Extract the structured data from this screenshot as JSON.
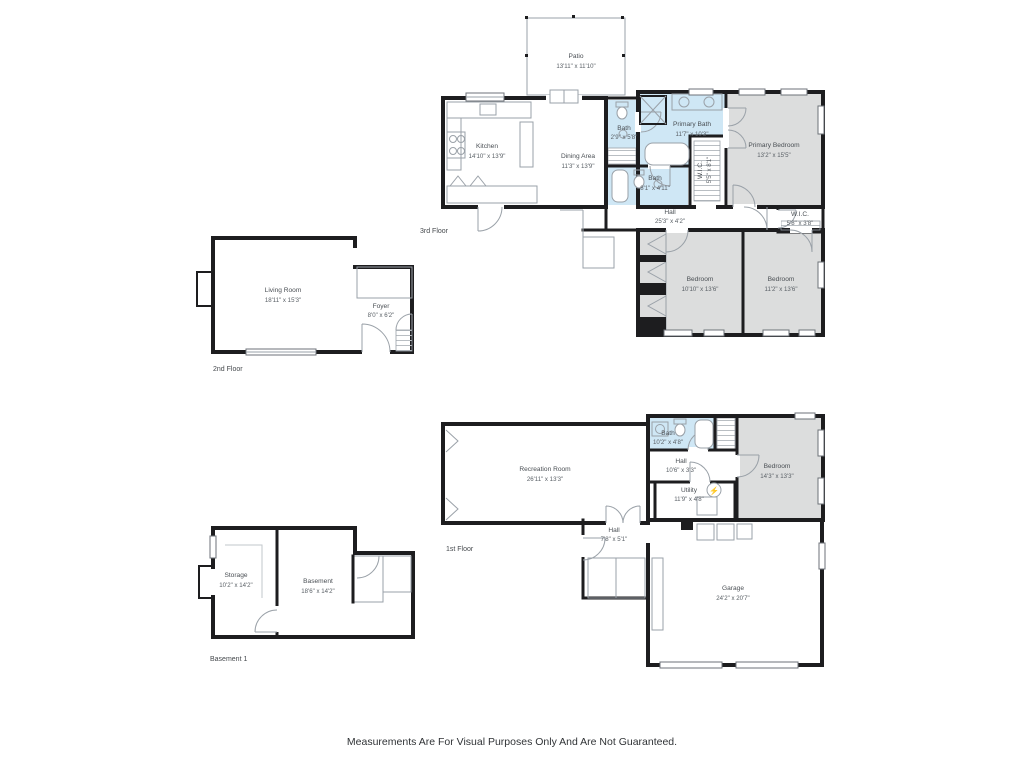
{
  "disclaimer": "Measurements Are For Visual Purposes Only And Are Not Guaranteed.",
  "icons": {
    "electrical_panel": "⚡"
  },
  "colors": {
    "wall": "#1d1d1f",
    "bath_fill": "#cfe7f5",
    "bedroom_fill": "#dcdddd",
    "fixture_line": "#9aa1a8",
    "text": "#4a4f54"
  },
  "floors": {
    "third": {
      "label": "3rd Floor",
      "rooms": {
        "patio": {
          "name": "Patio",
          "dims": "13'11\" x 11'10\""
        },
        "kitchen": {
          "name": "Kitchen",
          "dims": "14'10\" x 13'9\""
        },
        "dining": {
          "name": "Dining Area",
          "dims": "11'3\" x 13'9\""
        },
        "bath_wc": {
          "name": "Bath",
          "dims": "2'9\" x 5'8\""
        },
        "primary_bath": {
          "name": "Primary Bath",
          "dims": "11'7\" x 10'3\""
        },
        "primary_bedroom": {
          "name": "Primary Bedroom",
          "dims": "13'2\" x 15'5\""
        },
        "wic_a": {
          "name": "W.I.C.",
          "dims": "5'5\" x 8'1\""
        },
        "bath_b": {
          "name": "Bath",
          "dims": "8'1\" x 4'11\""
        },
        "hall": {
          "name": "Hall",
          "dims": "25'3\" x 4'2\""
        },
        "wic_b": {
          "name": "W.I.C.",
          "dims": "5'8\" x 3'8\""
        },
        "bedroom_a": {
          "name": "Bedroom",
          "dims": "10'10\" x 13'6\""
        },
        "bedroom_b": {
          "name": "Bedroom",
          "dims": "11'2\" x 13'6\""
        }
      }
    },
    "second": {
      "label": "2nd Floor",
      "rooms": {
        "living": {
          "name": "Living Room",
          "dims": "18'11\" x 15'3\""
        },
        "foyer": {
          "name": "Foyer",
          "dims": "8'0\" x 6'2\""
        }
      }
    },
    "first": {
      "label": "1st Floor",
      "rooms": {
        "recreation": {
          "name": "Recreation Room",
          "dims": "26'11\" x 13'3\""
        },
        "bath": {
          "name": "Bath",
          "dims": "10'2\" x 4'8\""
        },
        "hall_a": {
          "name": "Hall",
          "dims": "10'6\" x 3'3\""
        },
        "utility": {
          "name": "Utility",
          "dims": "11'9\" x 4'8\""
        },
        "bedroom": {
          "name": "Bedroom",
          "dims": "14'3\" x 13'3\""
        },
        "hall_b": {
          "name": "Hall",
          "dims": "7'8\" x 5'1\""
        },
        "garage": {
          "name": "Garage",
          "dims": "24'2\" x 20'7\""
        }
      }
    },
    "basement": {
      "label": "Basement 1",
      "rooms": {
        "storage": {
          "name": "Storage",
          "dims": "10'2\" x 14'2\""
        },
        "basement": {
          "name": "Basement",
          "dims": "18'6\" x 14'2\""
        }
      }
    }
  }
}
